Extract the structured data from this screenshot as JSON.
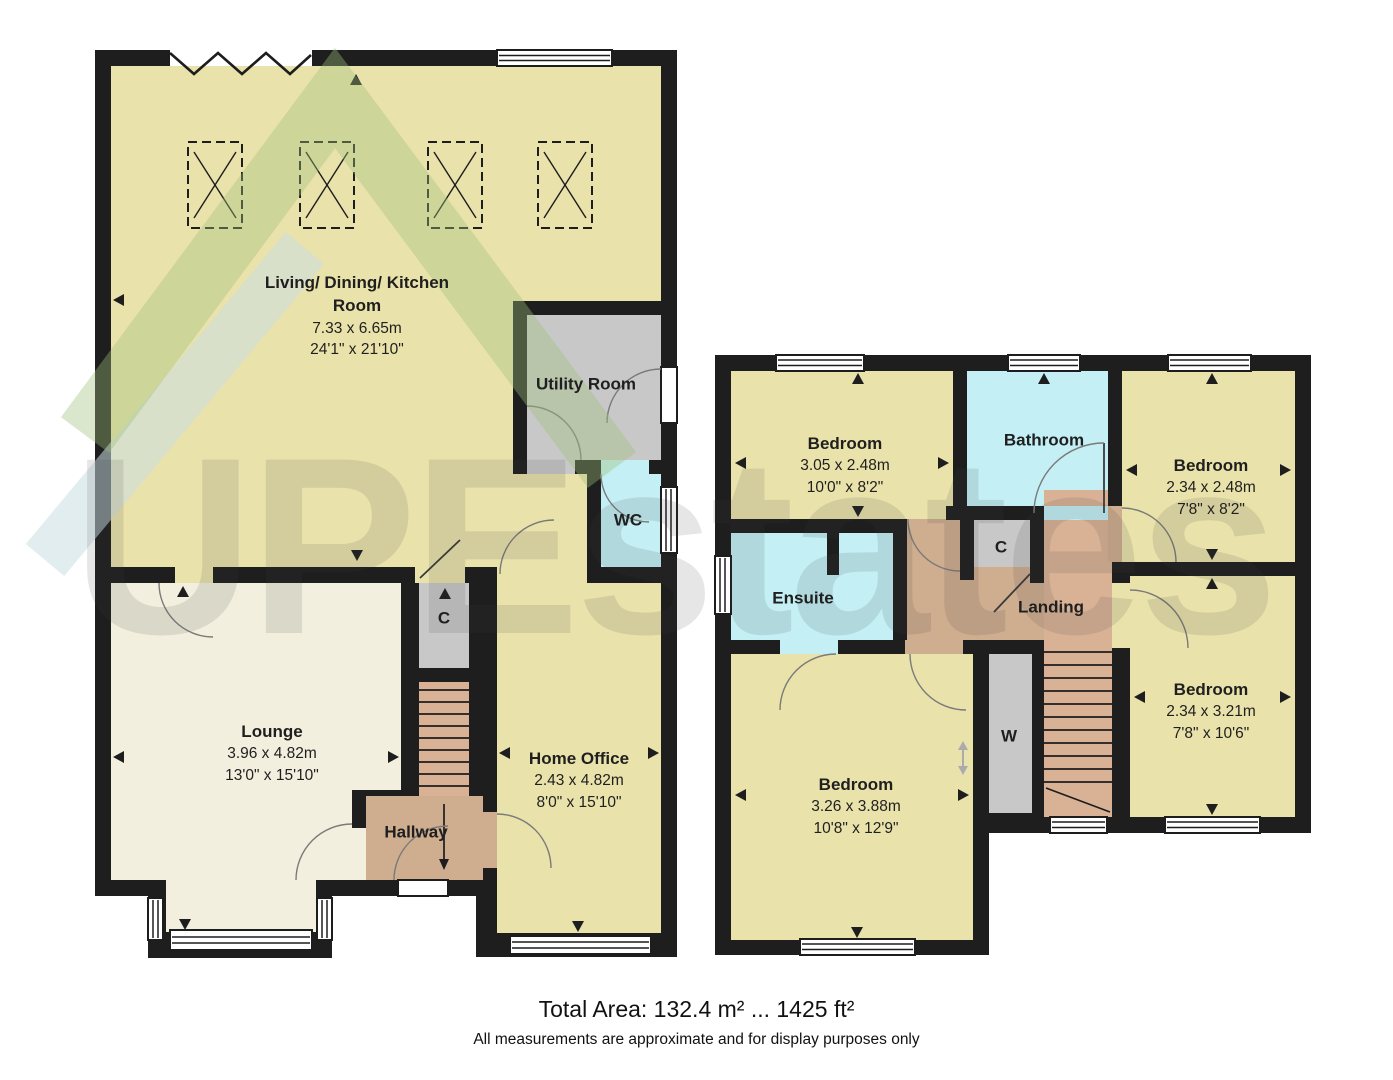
{
  "rooms": {
    "living": {
      "name": "Living/ Dining/ Kitchen Room",
      "dim_m": "7.33 x 6.65m",
      "dim_ft": "24'1\" x 21'10\""
    },
    "utility": {
      "name": "Utility Room"
    },
    "wc": {
      "name": "WC"
    },
    "lounge": {
      "name": "Lounge",
      "dim_m": "3.96 x 4.82m",
      "dim_ft": "13'0\" x 15'10\""
    },
    "hallway": {
      "name": "Hallway"
    },
    "closet_ground": {
      "name": "C"
    },
    "home_office": {
      "name": "Home Office",
      "dim_m": "2.43 x 4.82m",
      "dim_ft": "8'0\" x 15'10\""
    },
    "bedroom_top_left": {
      "name": "Bedroom",
      "dim_m": "3.05 x 2.48m",
      "dim_ft": "10'0\" x 8'2\""
    },
    "bathroom": {
      "name": "Bathroom"
    },
    "bedroom_top_right": {
      "name": "Bedroom",
      "dim_m": "2.34 x 2.48m",
      "dim_ft": "7'8\" x 8'2\""
    },
    "ensuite": {
      "name": "Ensuite"
    },
    "landing": {
      "name": "Landing"
    },
    "closet_first": {
      "name": "C"
    },
    "wardrobe": {
      "name": "W"
    },
    "bedroom_bottom_left": {
      "name": "Bedroom",
      "dim_m": "3.26 x 3.88m",
      "dim_ft": "10'8\" x 12'9\""
    },
    "bedroom_bottom_right": {
      "name": "Bedroom",
      "dim_m": "2.34 x 3.21m",
      "dim_ft": "7'8\" x 10'6\""
    }
  },
  "watermark": {
    "text": "UPEstates"
  },
  "footer": {
    "total_area": "Total Area: 132.4 m² ... 1425 ft²",
    "disclaimer": "All measurements are approximate and for display purposes only"
  },
  "colors": {
    "wall": "#1E1E1E",
    "room_yellow": "#EAE2AB",
    "lounge_cream": "#F2EFDE",
    "hall_tan": "#CFAD8F",
    "stairs_tan": "#D9B296",
    "closet_gray": "#C8C8C8",
    "wet_cyan": "#C3EFF5",
    "watermark_green": "#9DBF79",
    "watermark_blue": "#CBDFE4"
  }
}
